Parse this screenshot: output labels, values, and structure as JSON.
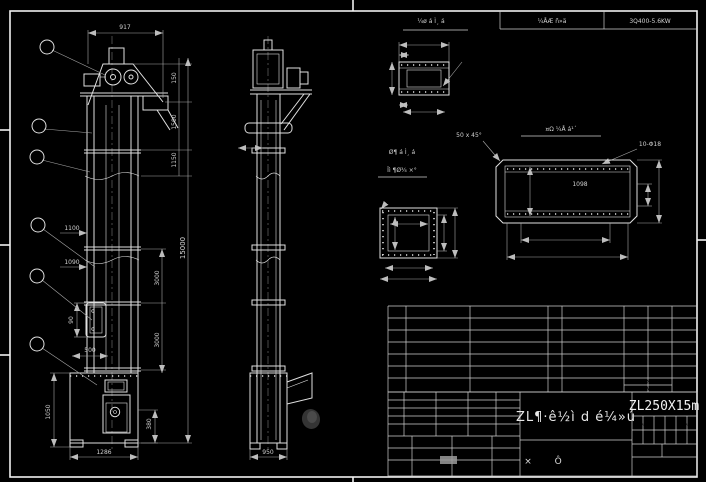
{
  "colors": {
    "background": "#000000",
    "line": "#e0e0e0",
    "dim_text": "#cfcfcf"
  },
  "header": {
    "cell_project": "¼ÅÆ ñ»ä",
    "cell_model": "3Q400-5.6KW"
  },
  "front_view": {
    "balloons": [
      "1",
      "2",
      "3",
      "4",
      "5",
      "6"
    ],
    "dim_top_width": "917",
    "dim_head": "150",
    "dim_head2": "1500",
    "dim_head3": "1150",
    "dim_total": "15000",
    "dim_sect1": "3000",
    "dim_sect2": "3000",
    "dim_door1": "1100",
    "dim_door2": "1090",
    "dim_win": "90",
    "dim_door_w": "500",
    "dim_boot_h": "1050",
    "dim_boot_h2": "25",
    "dim_boot_r": "380",
    "dim_boot_r2": "28",
    "dim_boot_w": "1286"
  },
  "side_view": {
    "dim_collar": "450",
    "dim_boot_w": "950"
  },
  "detail_top_flange": {
    "title": "¼ø á Ì¸ á",
    "dim_width": "440",
    "dim_offset": "30",
    "dim_left": "2X100=200",
    "dim_inner": "95",
    "label_holes": "11-Φ14",
    "dim_small": "40",
    "dim_bottom": "4X100=400"
  },
  "detail_square_flange": {
    "title_line1": "Ø¶ á Ì¸ á",
    "title_line2": "Ïì ¶Ø¾ ×°",
    "label_holes": "14-Φ14",
    "dim_inner_w": "305",
    "dim_inner_h": "300",
    "dim_right1": "360",
    "dim_right2": "430",
    "dim_bottom1": "4X87.5=350",
    "dim_bottom2": "430"
  },
  "detail_inlet": {
    "title": "¤Ω ¼Å á¹´",
    "label_chamfer": "50 x 45°",
    "label_holes": "10-Φ18",
    "dim_inner": "1098",
    "dim_left": "380",
    "dim_right1": "150",
    "dim_right2": "470",
    "dim_bottom1": "2X400=800",
    "dim_bottom2": "1180"
  },
  "bom": {
    "rows": [
      {
        "no": "6",
        "code": "",
        "name": "Ø¶ ×° Âµ",
        "qty": "1",
        "material": "¹ ¼Ö"
      },
      {
        "no": "5",
        "code": "",
        "name": "±Ç ·3 ¸´ 1µ",
        "qty": "",
        "material": ""
      },
      {
        "no": "4",
        "code": "",
        "name": "±ä ×Ø¾ tØ=2000",
        "qty": "5",
        "material": "¹¾6 ÏÖ"
      },
      {
        "no": "3",
        "code": "",
        "name": "·C ±ä ¾tØ=1500mm",
        "qty": "1",
        "material": "¹¾6 ÏÖ"
      },
      {
        "no": "2",
        "code": "",
        "name": "ä¶Ø ×° Âµ",
        "qty": "1",
        "material": "¹ ¼Ö"
      },
      {
        "no": "1",
        "code": "",
        "name": "Ç¶ °X° ÕÅ",
        "qty": "1X",
        "material": "¼Å Æ·"
      }
    ],
    "headers": {
      "no": "Ø¶Ç",
      "code": "´ ¹Å",
      "name": "Ã ¬ Æ",
      "qty": "Ø¹",
      "material": "² Å ä Ï",
      "weight1": "±Ç¾X ¹ÏÆ",
      "weight2": "ÕÅ ·¸",
      "note": "±, X Ø"
    }
  },
  "titleblock": {
    "main_title": "ZL¶·ê½ì d é¼»ú",
    "model": "ZL250X15m",
    "sheet_label": "× Ô",
    "label1": "±ÅÇ¶",
    "label2": "¸Ø¾¼Å",
    "label3": "Ç©×Ö",
    "label4": "ÈÕÆÚ",
    "small1": "¼Æ ¾Ø",
    "small2": "¼Ø ¾¼",
    "r1": "±ì ¼Ç",
    "r2": "ÇÏ ±ç",
    "r3": "±ì ¼Ç",
    "b1": "¹² ÕÅ",
    "b2": "µÚ ÕÅ"
  }
}
